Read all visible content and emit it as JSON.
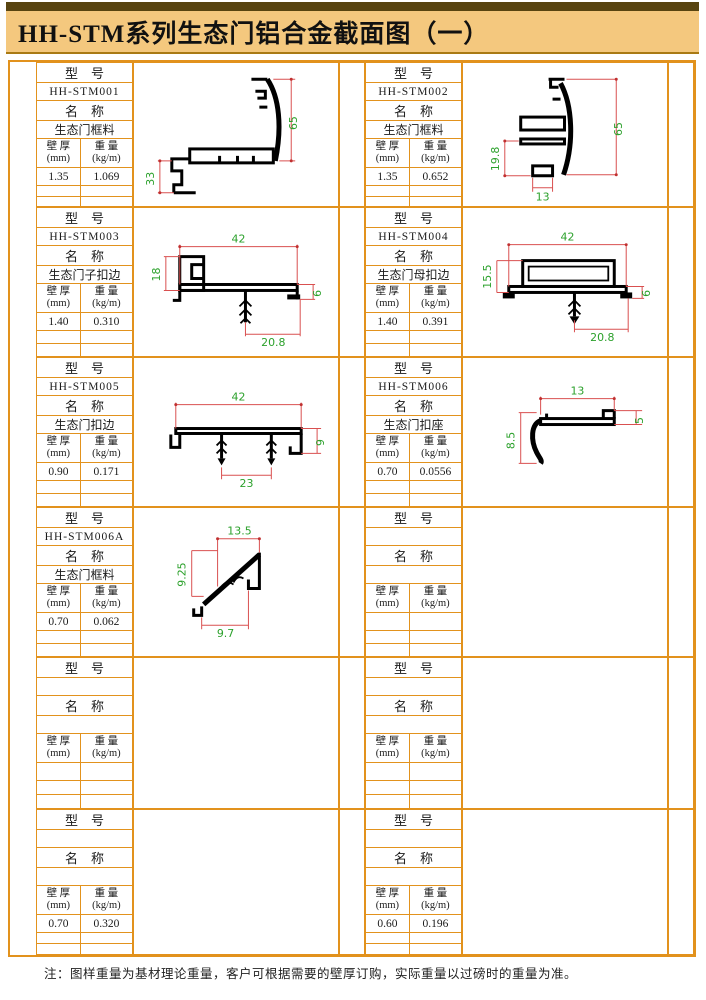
{
  "title": "HH-STM系列生态门铝合金截面图（一）",
  "note": "注：图样重量为基材理论重量，客户可根据需要的壁厚订购，实际重量以过磅时的重量为准。",
  "table_labels": {
    "model_header": "型　号",
    "name_header": "名　称",
    "thickness_line1": "壁 厚",
    "thickness_line2": "(mm)",
    "weight_line1": "重 量",
    "weight_line2": "(kg/m)"
  },
  "colors": {
    "frame_orange": "#E2921D",
    "title_background": "#F4C87E",
    "top_bar_brown": "#584410",
    "dimension_line_red": "#D95050",
    "dimension_text_green": "#2CA12C",
    "profile_black": "#000000"
  },
  "sections": [
    {
      "model": "HH-STM001",
      "name": "生态门框料",
      "thickness": "1.35",
      "weight": "1.069",
      "dims": [
        "65",
        "33"
      ]
    },
    {
      "model": "HH-STM002",
      "name": "生态门框料",
      "thickness": "1.35",
      "weight": "0.652",
      "dims": [
        "65",
        "19.8",
        "13"
      ]
    },
    {
      "model": "HH-STM003",
      "name": "生态门子扣边",
      "thickness": "1.40",
      "weight": "0.310",
      "dims": [
        "42",
        "18",
        "6",
        "20.8"
      ]
    },
    {
      "model": "HH-STM004",
      "name": "生态门母扣边",
      "thickness": "1.40",
      "weight": "0.391",
      "dims": [
        "42",
        "15.5",
        "6",
        "20.8"
      ]
    },
    {
      "model": "HH-STM005",
      "name": "生态门扣边",
      "thickness": "0.90",
      "weight": "0.171",
      "dims": [
        "42",
        "23",
        "9"
      ]
    },
    {
      "model": "HH-STM006",
      "name": "生态门扣座",
      "thickness": "0.70",
      "weight": "0.0556",
      "dims": [
        "13",
        "8.5",
        "5"
      ]
    },
    {
      "model": "HH-STM006A",
      "name": "生态门框料",
      "thickness": "0.70",
      "weight": "0.062",
      "dims": [
        "13.5",
        "9.25",
        "9.7"
      ]
    },
    {
      "model": "",
      "name": "",
      "thickness": "",
      "weight": "",
      "dims": []
    },
    {
      "model": "",
      "name": "",
      "thickness": "",
      "weight": "",
      "dims": []
    },
    {
      "model": "",
      "name": "",
      "thickness": "",
      "weight": "",
      "dims": []
    },
    {
      "model": "",
      "name": "",
      "thickness": "0.70",
      "weight": "0.320",
      "dims": []
    },
    {
      "model": "",
      "name": "",
      "thickness": "0.60",
      "weight": "0.196",
      "dims": []
    }
  ]
}
